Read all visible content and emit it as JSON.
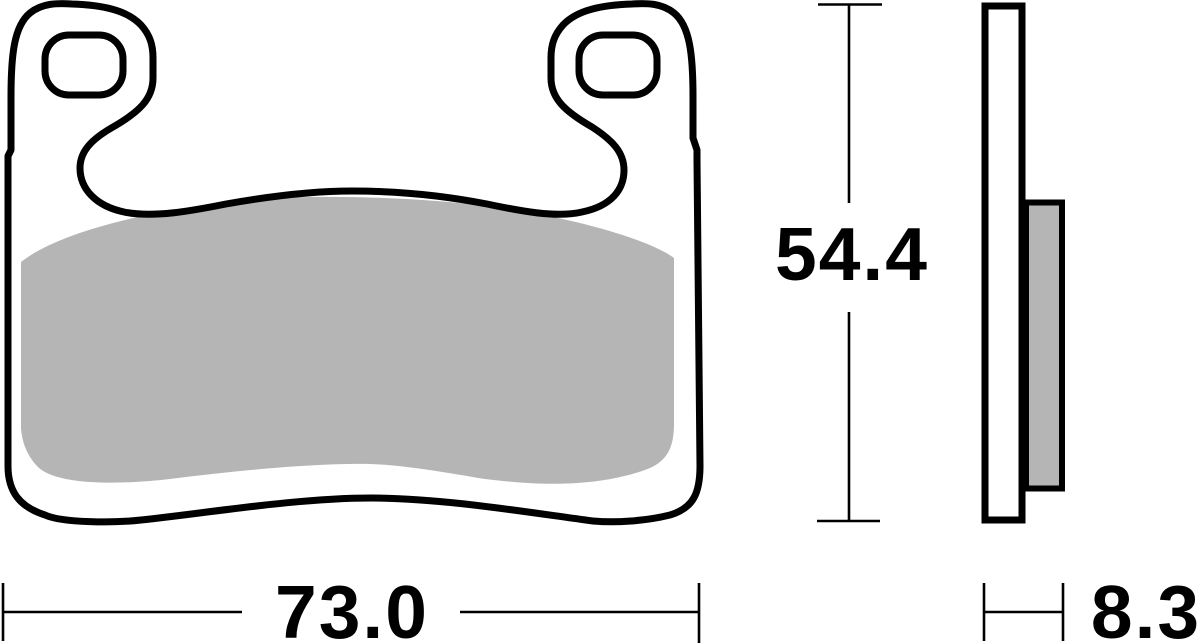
{
  "diagram": {
    "dimensions": {
      "width": "73.0",
      "height": "54.4",
      "thickness": "8.3"
    },
    "colors": {
      "outline": "#000000",
      "friction_material": "#b5b5b5",
      "background": "#ffffff"
    }
  }
}
